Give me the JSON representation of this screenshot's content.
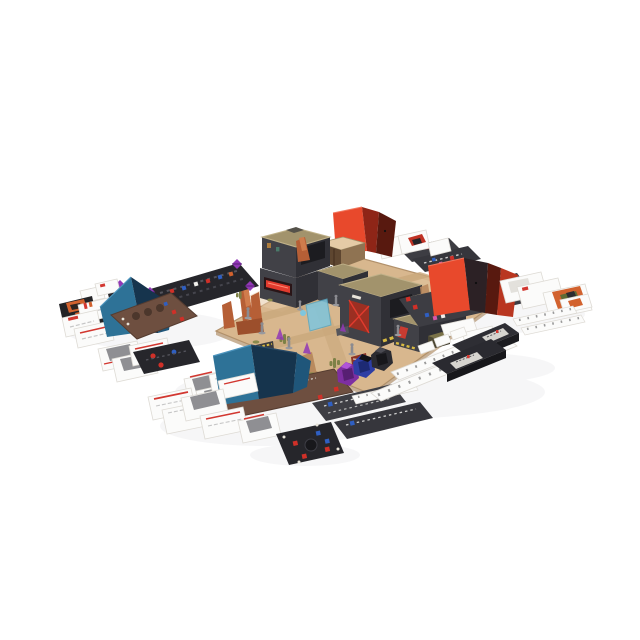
{
  "scene": {
    "description": "Board game tabletop product photo: desert city map board with 3D cardboard buildings, four folded player screens (two blue, two red), brown and black player boards, fanned white and black cards, white track strips, black deck trays, purple-blue-black faceted dice, purple gem dice, cube tokens and gray miniatures on a white background",
    "items": [
      {
        "id": "desert-game-board",
        "label": "modular desert city map board"
      },
      {
        "id": "building-left",
        "label": "two-story cardboard building with red neon sign"
      },
      {
        "id": "building-right",
        "label": "L-shaped cardboard building block with hazard stripes and red door"
      },
      {
        "id": "red-canopy-screen",
        "label": "red folded screen behind buildings"
      },
      {
        "id": "red-player-screen",
        "label": "red player screen on dark player board (right)"
      },
      {
        "id": "blue-player-screen-left",
        "label": "blue player screen on brown player board (left)"
      },
      {
        "id": "blue-player-screen-bottom",
        "label": "blue player screen on brown player board (bottom)"
      },
      {
        "id": "initiative-track-board",
        "label": "black track board with colored slots and purple gem dice"
      },
      {
        "id": "card-fans",
        "label": "fanned white reference cards and black character cards"
      },
      {
        "id": "track-strips",
        "label": "white tick-marked track strips"
      },
      {
        "id": "deck-boxes",
        "label": "black card deck trays with gray labels"
      },
      {
        "id": "dice-set",
        "label": "purple, blue and black faceted dice"
      },
      {
        "id": "black-token-board",
        "label": "black square board with red and blue cubes"
      },
      {
        "id": "miniatures",
        "label": "unpainted gray miniatures"
      },
      {
        "id": "terrain",
        "label": "orange rock spires, cacti, barricades, cyan holo barrier"
      }
    ]
  },
  "palette": {
    "background": "#ffffff",
    "shadow": "#e6e6ea",
    "board-tan": "#d8b78e",
    "board-tan-light": "#e5cba6",
    "board-road": "#c9a87c",
    "board-edge": "#b2916b",
    "building-wall": "#414147",
    "building-wall-dark": "#303036",
    "building-roof": "#a2936c",
    "building-roof-light": "#c0b189",
    "hazard-yellow": "#d8ba42",
    "sign-red": "#e23b2e",
    "door-red": "#9c2f22",
    "rock-orange": "#b65f36",
    "rock-orange-dark": "#9c4f2c",
    "rock-orange-light": "#d07c4c",
    "rock-tan": "#b98a5e",
    "screen-teal": "#2e7297",
    "screen-teal-light": "#4d94bd",
    "screen-teal-dark": "#1f567a",
    "screen-navy": "#16344d",
    "screen-red": "#e8492c",
    "screen-red-mid": "#b93620",
    "screen-red-deep": "#58190f",
    "screen-inner-dark": "#2c2125",
    "board-brown": "#6e4f40",
    "board-brown-dark": "#553c30",
    "well-brown": "#4c372c",
    "panel-black": "#26262b",
    "panel-gray": "#3d3d43",
    "panel-gray-2": "#36363c",
    "card-white": "#fbfbfa",
    "card-border": "#dedbd5",
    "card-line": "#c6c6c6",
    "photo-gray": "#8f8f93",
    "stripe-red": "#d23730",
    "art-orange": "#d2622e",
    "art-green": "#5f6b35",
    "die-purple": "#7e2fa2",
    "die-purple-dark": "#571f73",
    "die-purple-light": "#b055d8",
    "die-blue": "#2e3ea4",
    "die-blue-dark": "#1d2a74",
    "die-black": "#2b2b31",
    "die-black-dark": "#17171b",
    "mini-gray": "#8b8b90",
    "cactus-green": "#7d8146",
    "tuft-olive": "#8a8a4d",
    "gem-purple": "#9138b6",
    "cube-red": "#d03028",
    "cube-blue": "#2f5fc2",
    "token-cyan": "#7ec6de",
    "track-tick": "#9a9a9a",
    "label-gray": "#d6d4cf",
    "pink-icon": "#d657a8"
  }
}
